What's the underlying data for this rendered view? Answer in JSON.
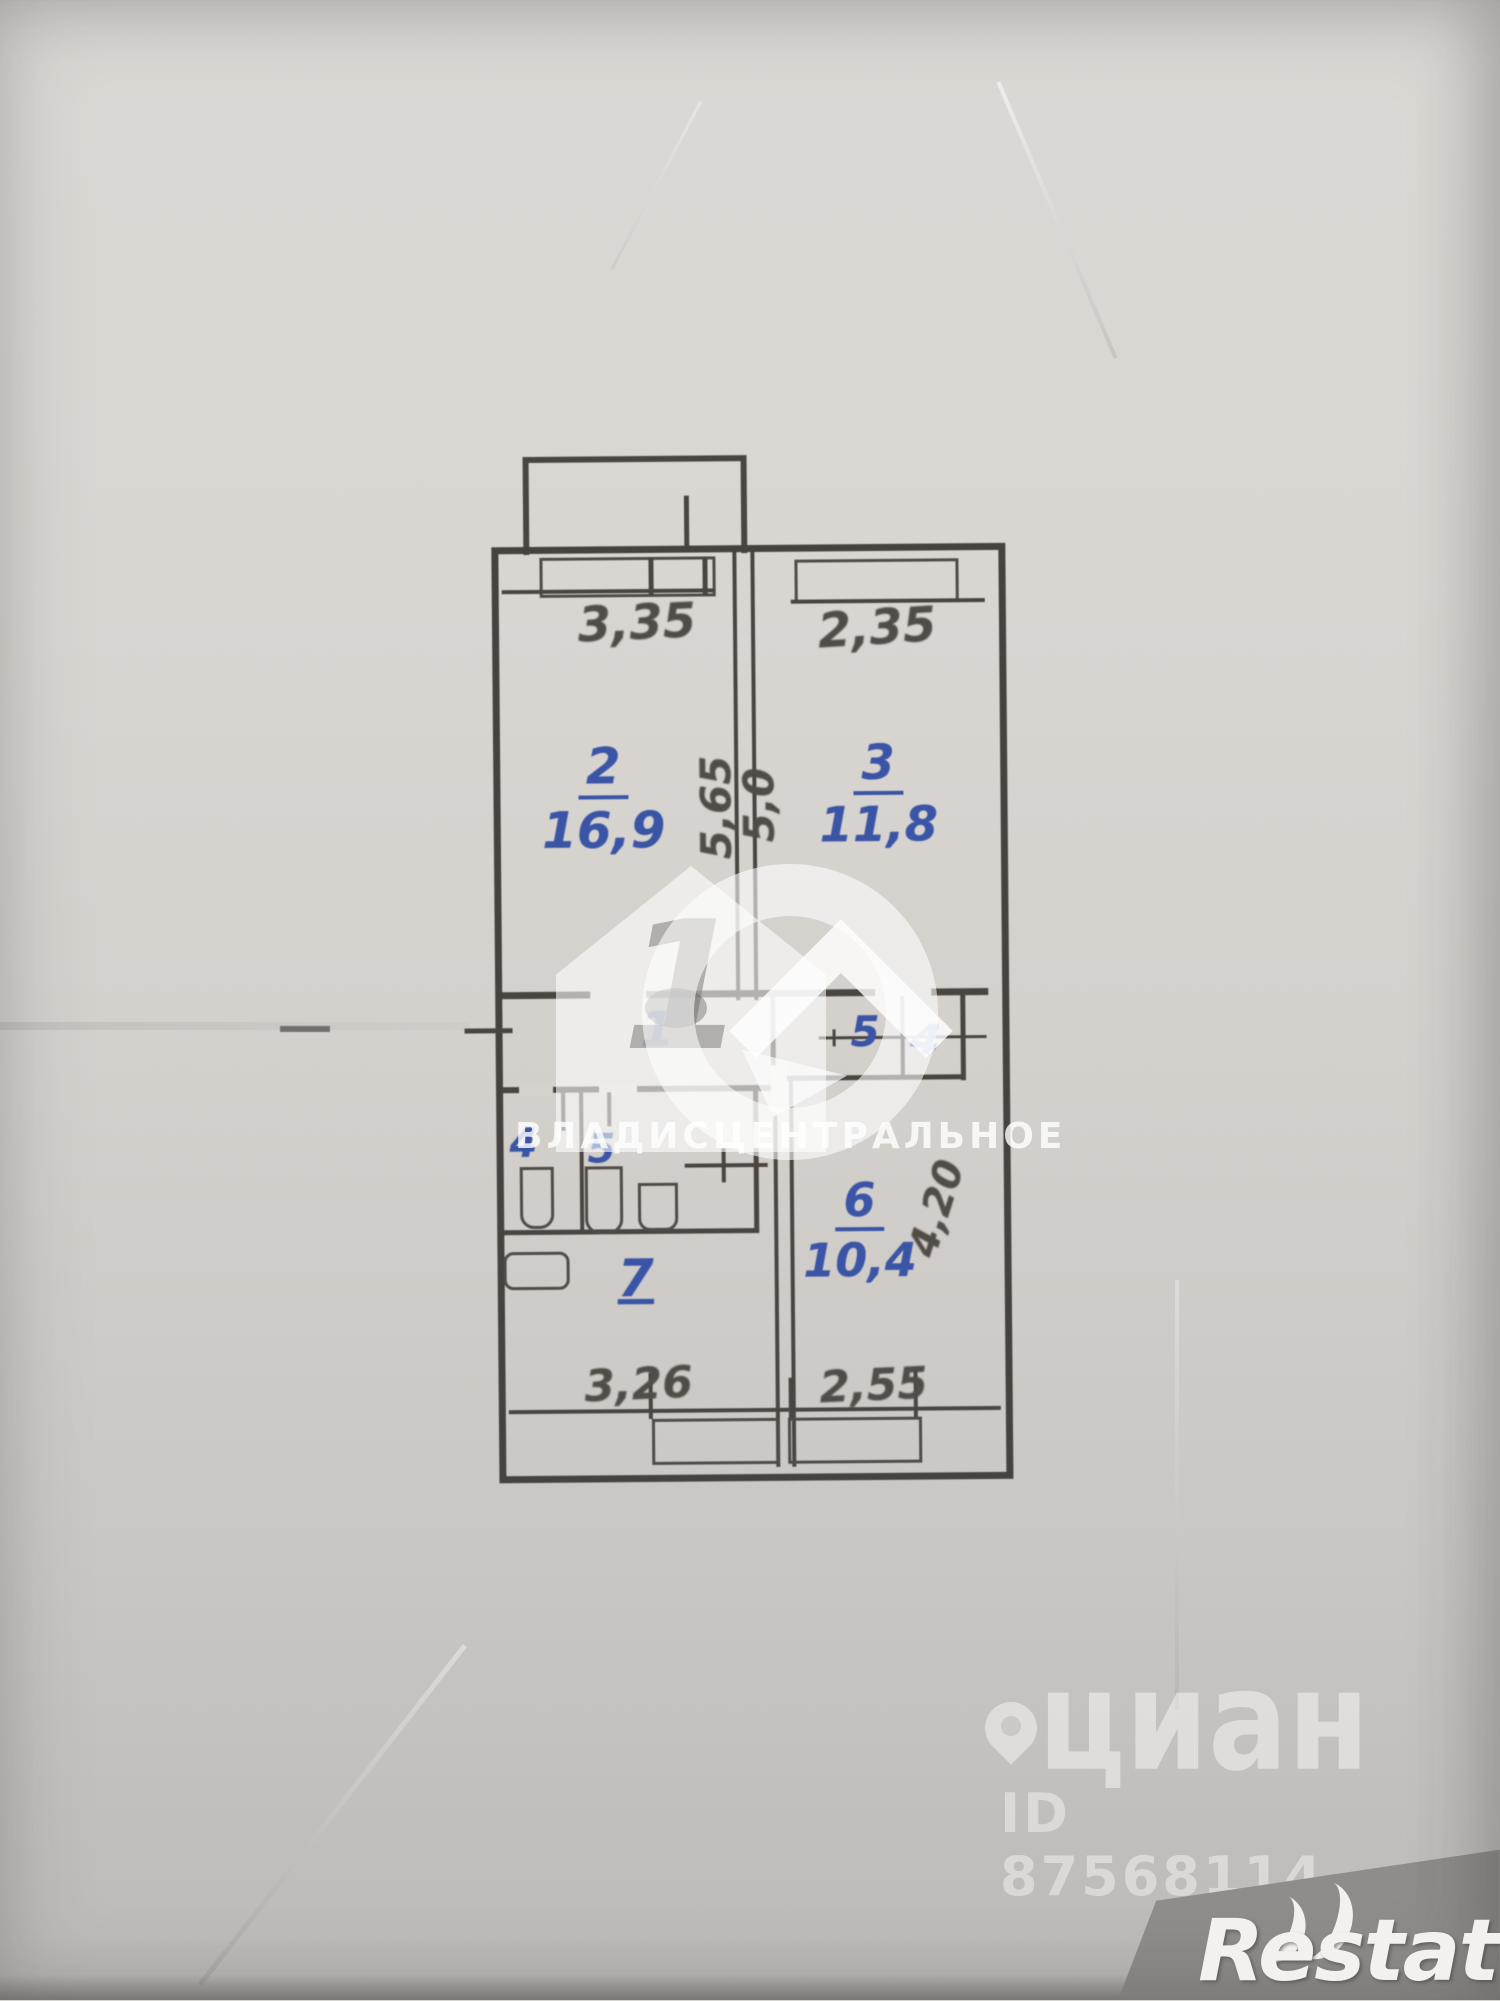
{
  "plan": {
    "room2": {
      "number": "2",
      "area": "16,9"
    },
    "room3": {
      "number": "3",
      "area": "11,8"
    },
    "room6": {
      "number": "6",
      "area": "10,4"
    },
    "hall": {
      "number": "1"
    },
    "closet_left": {
      "number": "5"
    },
    "closet_right": {
      "number": "4"
    },
    "wc": {
      "number": "4"
    },
    "bath": {
      "number": "5"
    },
    "kitchen": {
      "number": "7"
    },
    "dims": {
      "top_left": "3,35",
      "top_right": "2,35",
      "mid_left_vertical": "5,65",
      "mid_right_vertical": "5,0",
      "room6_vertical": "4,20",
      "bottom_left": "3,26",
      "bottom_right": "2,55"
    }
  },
  "watermarks": {
    "agency_logo_digit": "1",
    "agency_name": "ВЛАДИСЦЕНТРАЛЬНОЕ",
    "portal_name": "циан",
    "listing_id": "ID 87568114",
    "footer_brand": "Restate"
  },
  "colors": {
    "paper": "#d5d2ce",
    "ink_blue": "#3b55a6",
    "pencil": "#524c47",
    "watermark_white": "rgba(255,255,255,0.6)"
  }
}
